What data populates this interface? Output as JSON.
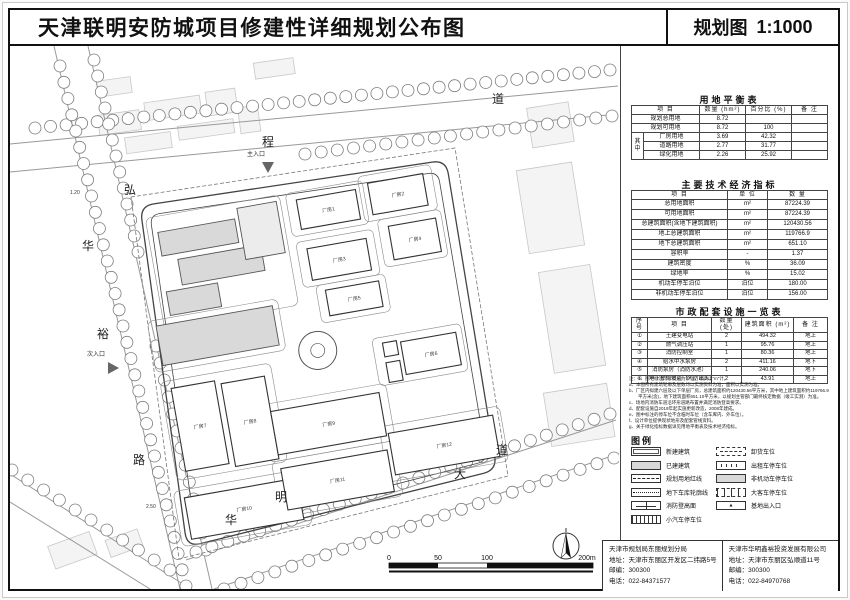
{
  "header": {
    "title": "天津联明安防城项目修建性详细规划公布图",
    "drawing_type": "规划图",
    "scale": "1:1000"
  },
  "map": {
    "road_labels": [
      "程",
      "道",
      "弘",
      "华",
      "裕",
      "路",
      "华",
      "明",
      "大",
      "道"
    ],
    "entrance_main": "主入口",
    "entrance_secondary": "次入口",
    "elevation_1": "1.20",
    "elevation_2": "2.50",
    "buildings": [
      "厂房1",
      "厂房2",
      "厂房3",
      "厂房4",
      "厂房5",
      "厂房6",
      "厂房7",
      "厂房8",
      "厂房9",
      "厂房10",
      "厂房11",
      "厂房12"
    ],
    "scale_bar_ticks": [
      "0",
      "50",
      "100",
      "200m"
    ]
  },
  "land_use_table": {
    "title": "用地平衡表",
    "headers": [
      "项  目",
      "数量 (hm²)",
      "百分比 (%)",
      "备 注"
    ],
    "group_label": "其中",
    "rows": {
      "total": {
        "name": "规划总用地",
        "qty": "8.72",
        "pct": "",
        "note": ""
      },
      "usable": {
        "name": "规划可用地",
        "qty": "8.72",
        "pct": "100",
        "note": ""
      },
      "factory": {
        "name": "厂房用地",
        "qty": "3.69",
        "pct": "42.32",
        "note": ""
      },
      "road": {
        "name": "道路用地",
        "qty": "2.77",
        "pct": "31.77",
        "note": ""
      },
      "green": {
        "name": "绿化用地",
        "qty": "2.26",
        "pct": "25.92",
        "note": ""
      }
    }
  },
  "indicators_table": {
    "title": "主要技术经济指标",
    "headers": [
      "项  目",
      "单 位",
      "数  量"
    ],
    "rows": [
      [
        "总用地面积",
        "m²",
        "87224.39"
      ],
      [
        "可用地面积",
        "m²",
        "87224.39"
      ],
      [
        "总建筑面积(含地下建筑面积)",
        "m²",
        "120430.56"
      ],
      [
        "地上总建筑面积",
        "m²",
        "119766.9"
      ],
      [
        "地下总建筑面积",
        "m²",
        "651.10"
      ],
      [
        "容积率",
        "-",
        "1.37"
      ],
      [
        "建筑密度",
        "%",
        "36.09"
      ],
      [
        "绿地率",
        "%",
        "15.02"
      ],
      [
        "机动车停车泊位",
        "泊位",
        "180.00"
      ],
      [
        "非机动车停车泊位",
        "泊位",
        "156.00"
      ]
    ]
  },
  "facilities_table": {
    "title": "市政配套设施一览表",
    "headers": [
      "序号",
      "项  目",
      "数量 (处)",
      "建筑面积 (m²)",
      "备 注"
    ],
    "rows": [
      [
        "①",
        "土建变电站",
        "2",
        "494.32",
        "地上"
      ],
      [
        "②",
        "燃气调压站",
        "1",
        "95.76",
        "地上"
      ],
      [
        "③",
        "消防控制室",
        "1",
        "80.36",
        "地上"
      ],
      [
        "④",
        "给水中水泵房",
        "2",
        "411.16",
        "地下"
      ],
      [
        "⑤",
        "消防泵房（消防水池）",
        "1",
        "240.06",
        "地下"
      ],
      [
        "⑥",
        "地下车库坡道（人防出入口）",
        "2",
        "43.91",
        "地上"
      ]
    ]
  },
  "notes": {
    "lines": [
      "注：1、图中标注尺寸以米为单位，标高以“m”计。",
      "a、本图所有建筑轮廓及层数均以实测资料为准，面积以实测为准。",
      "b、厂区内拟建六层及以下单层厂房，总建筑面积约120430.56平方米，其中地上建筑面积约119766.9",
      "　　平方米(含)，地下建筑面积651.10平方米，以规划主管部门最终核定数据（竣工实测）为准。",
      "c、场地内消防车道沿环形道路布置并满足消防登高要求。",
      "d、配套设施自2019年起实施更新改造，2008年建成。",
      "e、图中标注的停车位不含临时车位（含车库内、外车位）。",
      "f、设计单位提供现状地形及配套管线资料。",
      "g、关于绿化指标数据详见用地平衡表及技术经济指标。"
    ]
  },
  "legend": {
    "title": "图例",
    "left": [
      {
        "symbol": "new-building",
        "label": "新建建筑"
      },
      {
        "symbol": "existing-building",
        "label": "已建建筑"
      },
      {
        "symbol": "red-line",
        "label": "规划用地红线"
      },
      {
        "symbol": "underground-outline",
        "label": "地下车库轮廓线"
      },
      {
        "symbol": "fire-lane",
        "label": "消防登高面"
      },
      {
        "symbol": "car-parking",
        "label": "小汽车停车位"
      }
    ],
    "right": [
      {
        "symbol": "unload-parking",
        "label": "卸货车位"
      },
      {
        "symbol": "taxi-parking",
        "label": "出租车停车位"
      },
      {
        "symbol": "moto-parking",
        "label": "非机动车停车位"
      },
      {
        "symbol": "bus-parking",
        "label": "大客车停车位"
      },
      {
        "symbol": "site-entrance",
        "label": "基地出入口"
      }
    ]
  },
  "footer": {
    "left": {
      "org": "天津市规划局东丽规划分局",
      "address": "地址：天津市东丽区开发区二纬路5号",
      "zip": "邮编：300300",
      "tel": "电话：022-84371577"
    },
    "right": {
      "org": "天津市华明鑫裕投资发展有限公司",
      "address": "地址：天津市东丽区弘顺道11号",
      "zip": "邮编：300300",
      "tel": "电话：022-84970768"
    }
  },
  "colors": {
    "line": "#111111",
    "existing_fill": "#d9d9d9",
    "context_fill": "#f4f4f4"
  }
}
